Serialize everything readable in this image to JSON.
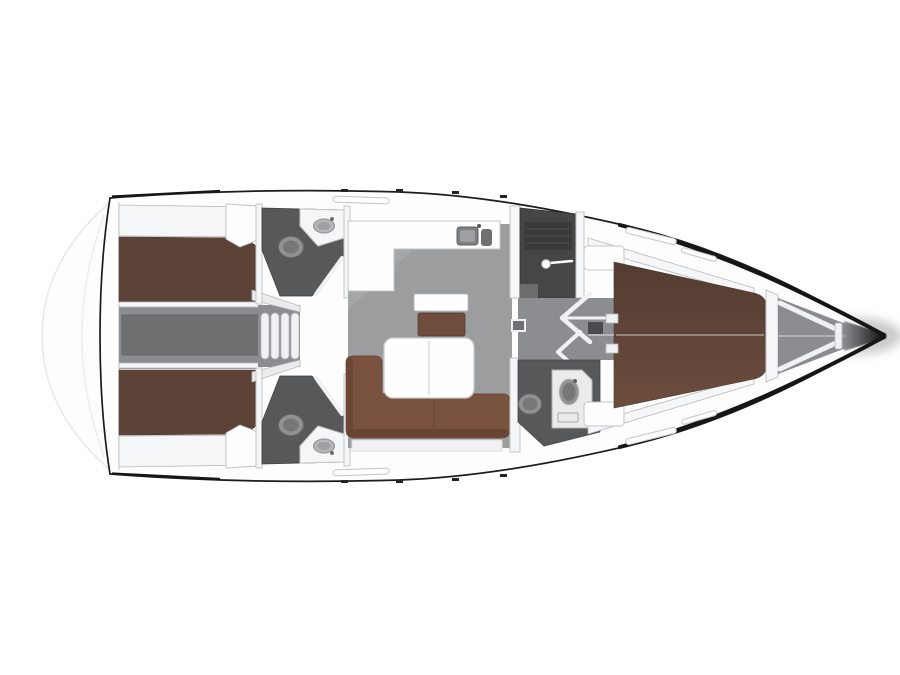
{
  "diagram": {
    "kind": "sailing-yacht-interior-floor-plan",
    "orientation": "bow-right",
    "rooms": [
      {
        "id": "swim-platform"
      },
      {
        "id": "aft-cabin-port",
        "berth": "double"
      },
      {
        "id": "aft-cabin-starboard",
        "berth": "double"
      },
      {
        "id": "engine-compartment"
      },
      {
        "id": "companionway-steps",
        "step_count": 4
      },
      {
        "id": "aft-head-port",
        "fixtures": [
          "toilet",
          "sink"
        ]
      },
      {
        "id": "aft-head-starboard",
        "fixtures": [
          "toilet",
          "sink"
        ]
      },
      {
        "id": "saloon",
        "furniture": [
          "l-sofa",
          "folding-table",
          "chart-seat"
        ]
      },
      {
        "id": "galley",
        "fixtures": [
          "double-sink"
        ]
      },
      {
        "id": "shower-room",
        "fixtures": [
          "shower-head",
          "grate",
          "bench"
        ]
      },
      {
        "id": "passageway",
        "markers": [
          "door-swings",
          "floor-hatch"
        ]
      },
      {
        "id": "forward-head",
        "fixtures": [
          "toilet",
          "vanity-sink"
        ]
      },
      {
        "id": "forward-cabin",
        "berth": "v-berth"
      },
      {
        "id": "anchor-locker"
      },
      {
        "id": "bow"
      }
    ]
  },
  "colors": {
    "background": "#ffffff",
    "deck": "#fdfdfd",
    "deck_shade": "#e9ebec",
    "wall": "#f5f6f7",
    "step": "#f0f1f2",
    "salon_floor": "#9b9d9f",
    "salon_floor_light": "#adaeb0",
    "corridor_floor": "#8b8d90",
    "engine_floor": "#6e7072",
    "head_floor": "#57585a",
    "shower_floor": "#454648",
    "shower_grate": "#393a3c",
    "berth": "#5d4337",
    "berth_dark": "#533c31",
    "berth_light": "#6d4d3e",
    "sofa": "#7a5240",
    "sofa_dark": "#684433",
    "seat": "#6f4c3b",
    "table": "#fefefe",
    "fixture": "#909294",
    "fixture_dark": "#757779",
    "fixture_ring": "#6a6c6e",
    "sink_outer": "#b4b6b8",
    "sink_inner": "#9da0a2",
    "sink_metal": "#7d7f81",
    "bow_gray": "#8b8c8f",
    "bow_tip": "#0b0b0c",
    "hull_outline": "#1c1c1e",
    "hull_edge_bold": "#161617"
  }
}
